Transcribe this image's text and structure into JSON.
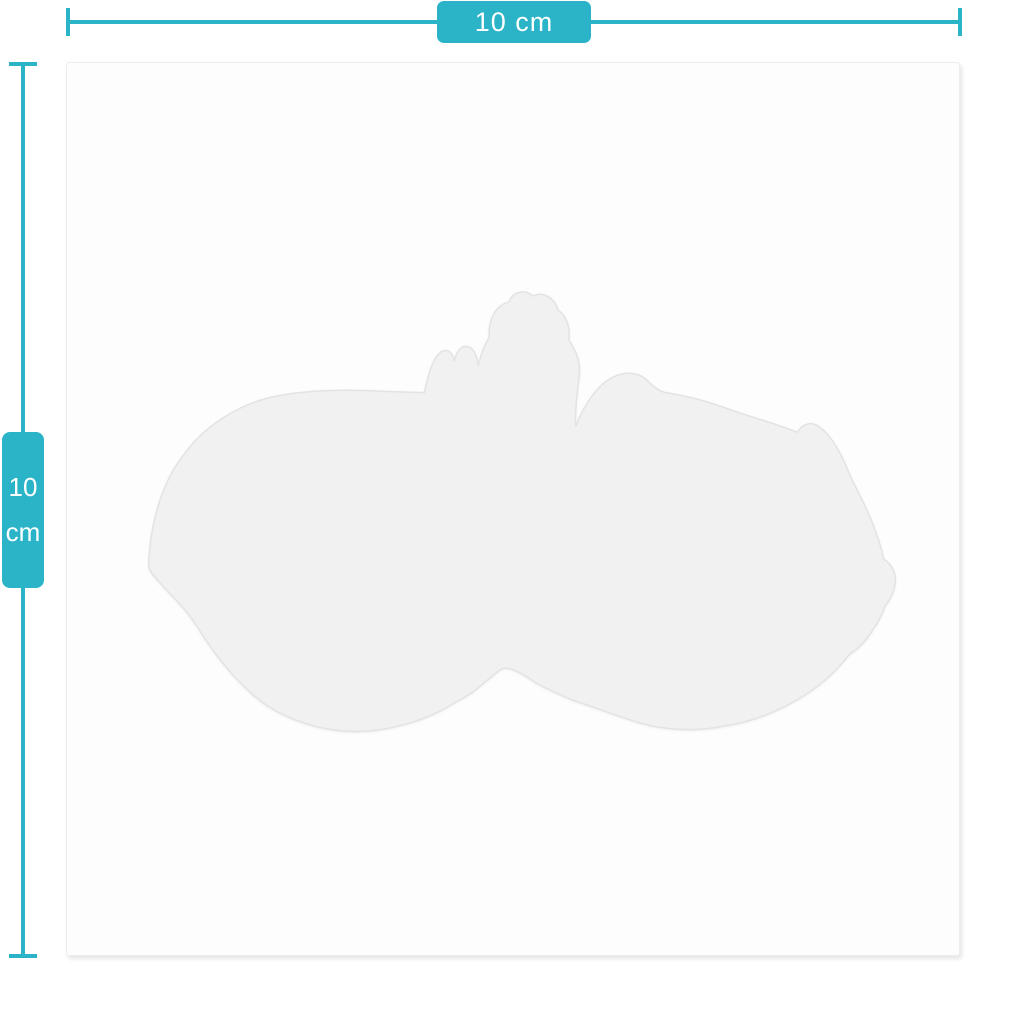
{
  "colors": {
    "accent": "#2bb4c8",
    "page_background": "#ffffff",
    "card_background": "#fdfdfd",
    "card_border": "#ededed",
    "sticker_fill": "#f1f1f2",
    "sticker_outline": "#e3e3e5"
  },
  "width_dimension": {
    "label": "10 cm"
  },
  "height_dimension": {
    "value": "10",
    "unit": "cm"
  }
}
